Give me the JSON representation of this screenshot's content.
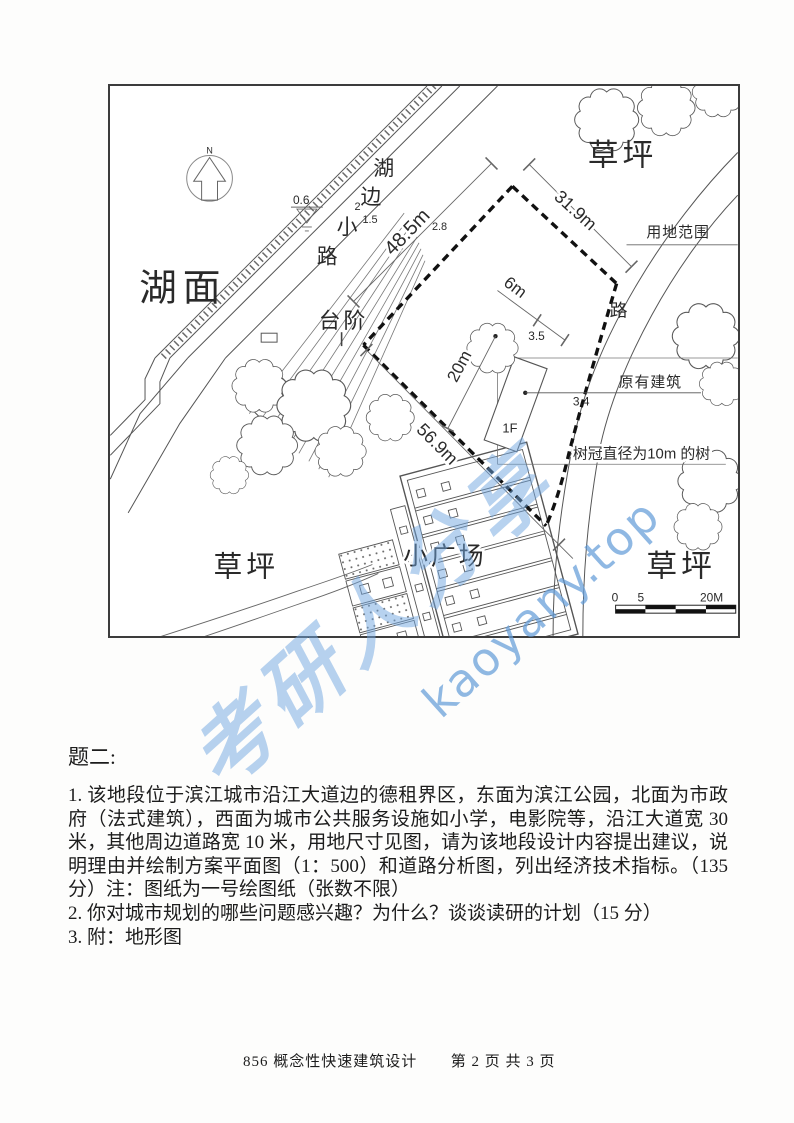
{
  "map": {
    "north_label": "N",
    "labels": {
      "lake": "湖面",
      "lakeside_path_chars": [
        "湖",
        "边",
        "小",
        "路"
      ],
      "steps": "台阶",
      "lawn_top_right": "草坪",
      "lawn_bottom_left": "草坪",
      "lawn_bottom_right": "草坪",
      "plaza": "小广场",
      "road": "路",
      "site_boundary": "用地范围",
      "existing_building": "原有建筑",
      "building_floor": "1F",
      "tree_note": "树冠直径为10m 的树"
    },
    "dimensions": {
      "nw_edge": "48.5m",
      "ne_edge": "31.9m",
      "sw_edge": "56.9m",
      "tree_to_boundary": "20m",
      "tree_to_building": "6m",
      "building_gap": "3.5",
      "building_spot": "3.4",
      "water_level": "0.6",
      "contours": [
        "2",
        "1.5",
        "2.8"
      ]
    },
    "scale_bar": {
      "start": "0",
      "mid": "5",
      "end": "20M"
    }
  },
  "question": {
    "title": "题二:",
    "items": [
      "1. 该地段位于滨江城市沿江大道边的德租界区，东面为滨江公园，北面为市政府（法式建筑），西面为城市公共服务设施如小学，电影院等，沿江大道宽 30 米，其他周边道路宽 10 米，用地尺寸见图，请为该地段设计内容提出建议，说明理由并绘制方案平面图（1：500）和道路分析图，列出经济技术指标。（135分）注：图纸为一号绘图纸（张数不限）",
      "2. 你对城市规划的哪些问题感兴趣？为什么？谈谈读研的计划（15 分）",
      "3. 附：地形图"
    ]
  },
  "footer": {
    "course": "856 概念性快速建筑设计",
    "page": "第 2 页 共 3 页"
  },
  "watermark": {
    "latin": "kaoyany.top",
    "chinese": "考研人分享"
  }
}
